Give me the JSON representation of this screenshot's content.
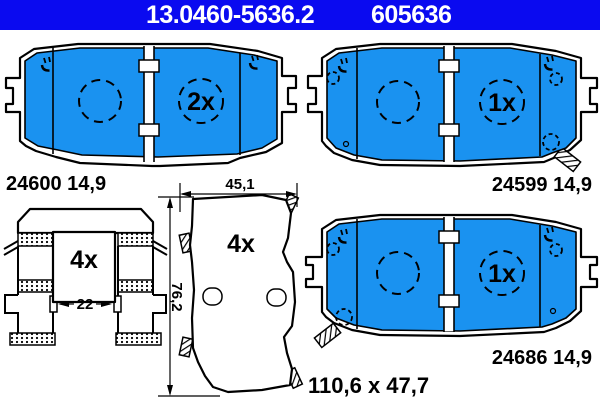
{
  "title": "ATE brake pad set technical drawing",
  "colors": {
    "header_blue": "#0a0af0",
    "pad_blue": "#1a92f0",
    "line": "#000000",
    "bg": "#ffffff"
  },
  "header": {
    "part_number": "13.0460-5636.2",
    "wva_number": "605636"
  },
  "pads": {
    "top_left": {
      "label": "24600 14,9",
      "quantity": "2x"
    },
    "top_right": {
      "label": "24599 14,9",
      "quantity": "1x"
    },
    "bottom_right": {
      "label": "24686 14,9",
      "quantity": "1x"
    }
  },
  "backplate": {
    "quantity": "4x"
  },
  "clip": {
    "quantity": "4x"
  },
  "dimensions": {
    "width": "45,1",
    "height": "76,2",
    "clip_gap": "22",
    "overall": "110,6 x 47,7"
  }
}
